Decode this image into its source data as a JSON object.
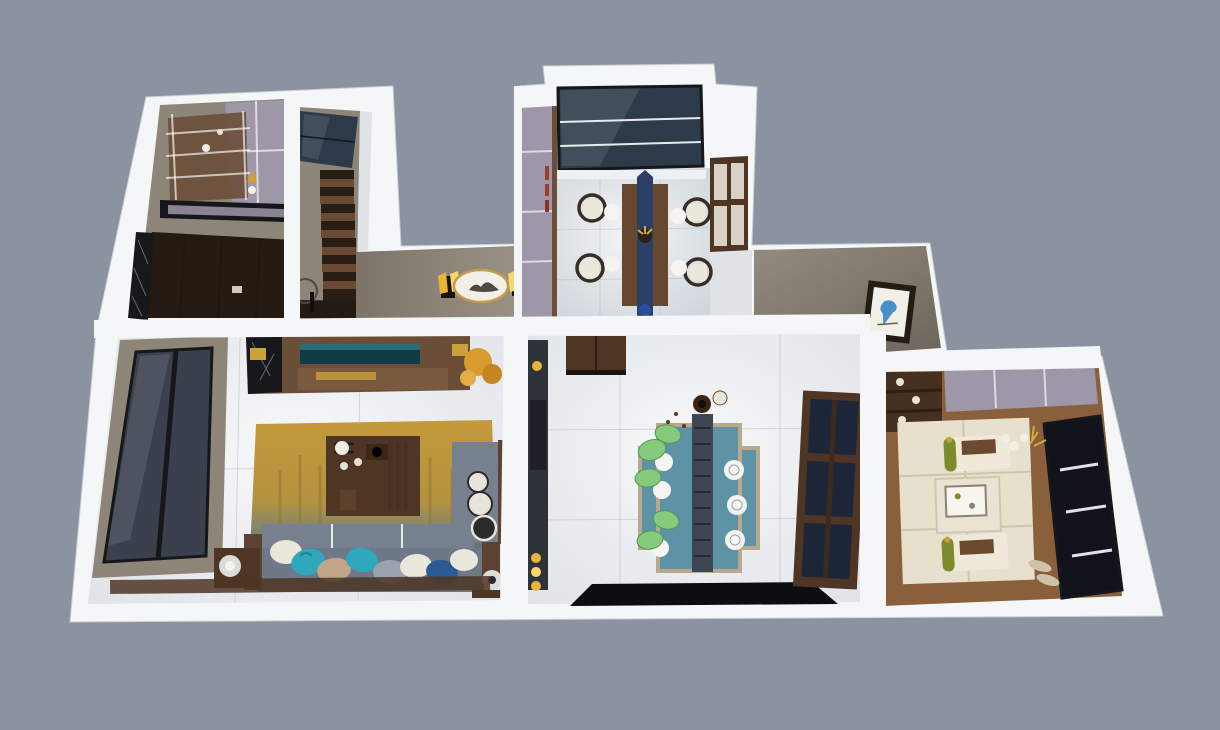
{
  "meta": {
    "description": "Top-down dollhouse 3D render of a furnished apartment floor plan on a plain slate background",
    "image_type": "3d-floorplan-render",
    "visible_text": "none"
  },
  "rooms": [
    {
      "id": "study-balcony",
      "label": "study and balcony room"
    },
    {
      "id": "stair-hall",
      "label": "staircase hall with skylight"
    },
    {
      "id": "entry-hall",
      "label": "entry hallway with sconces and oval art"
    },
    {
      "id": "dining-room",
      "label": "dining room with bay window"
    },
    {
      "id": "gallery-hall",
      "label": "corridor with framed bird picture"
    },
    {
      "id": "living-room",
      "label": "living room with sofa, gold rug and TV wall"
    },
    {
      "id": "kitchen-dining",
      "label": "family dining room with blue table and leaf chairs"
    },
    {
      "id": "tatami-room",
      "label": "tatami tea room with floor seats and dark window"
    }
  ],
  "palette": {
    "background": "#8b93a0",
    "outer_wall": "#f4f6f8",
    "wall_side": "#dde1e6",
    "taupe": "#8e8579",
    "taupe_dark": "#6e665c",
    "floor_light": "#dfe3e8",
    "floor_cool": "#ccd3da",
    "floor_warm": "#cfc9c2",
    "glass_navy": "#2c3a4a",
    "sill_white": "#eef1f4",
    "window_slate": "#3a414d",
    "frame_black": "#15171a",
    "wood_dark": "#4e3524",
    "wood_mid": "#6a4e37",
    "wood_warm": "#8a5f3c",
    "wood_console": "#7a5a3e",
    "wood_floor": "#7a5232",
    "lavender": "#9d97a8",
    "stair_tread": "#6b4a33",
    "stair_riser": "#2a1d14",
    "landing_dark": "#241a12",
    "gold": "#c9a23c",
    "rug_gold": "#c39a3b",
    "rug_teal": "#57707a",
    "sofa_seat": "#6e7887",
    "sofa_back": "#77808f",
    "armrest_wood": "#5c4232",
    "pillow_teal": "#2fa8bc",
    "pillow_navy": "#2b5b94",
    "pillow_tan": "#c2a488",
    "pillow_white": "#e9e6da",
    "pillow_gray": "#9aa3ad",
    "runner_navy": "#2c3f68",
    "dining_wood": "#66482f",
    "chair_cushion": "#ece7db",
    "chair_frame": "#3a2d22",
    "blue_table": "#5e93a5",
    "table_border": "#b8a98c",
    "runner_dark": "#3e4653",
    "leaf_green": "#86ca7e",
    "plate_white": "#f5f4f0",
    "tatami": "#e6e0cd",
    "bolster_green": "#7c8c2c",
    "bolster_brown": "#6b4a2e",
    "night_window": "#10121c",
    "sconce_gold": "#e8b43a",
    "sconce_glow": "#f7d96b",
    "oval_bg": "#f2efe8",
    "oval_rim": "#c69b4e",
    "bird_blue": "#4a90c8",
    "frame_dark": "#241c12",
    "black_marble": "#17181c",
    "rug_black": "#0d0e10",
    "tv_teal": "#0f3b44",
    "plant_gold": "#d79b2e",
    "cabinet_cream": "#d8d2c6",
    "book_red": "#a23a2e",
    "porcelain_blue": "#2a4fa0",
    "kitchen_dark": "#2e333b"
  }
}
